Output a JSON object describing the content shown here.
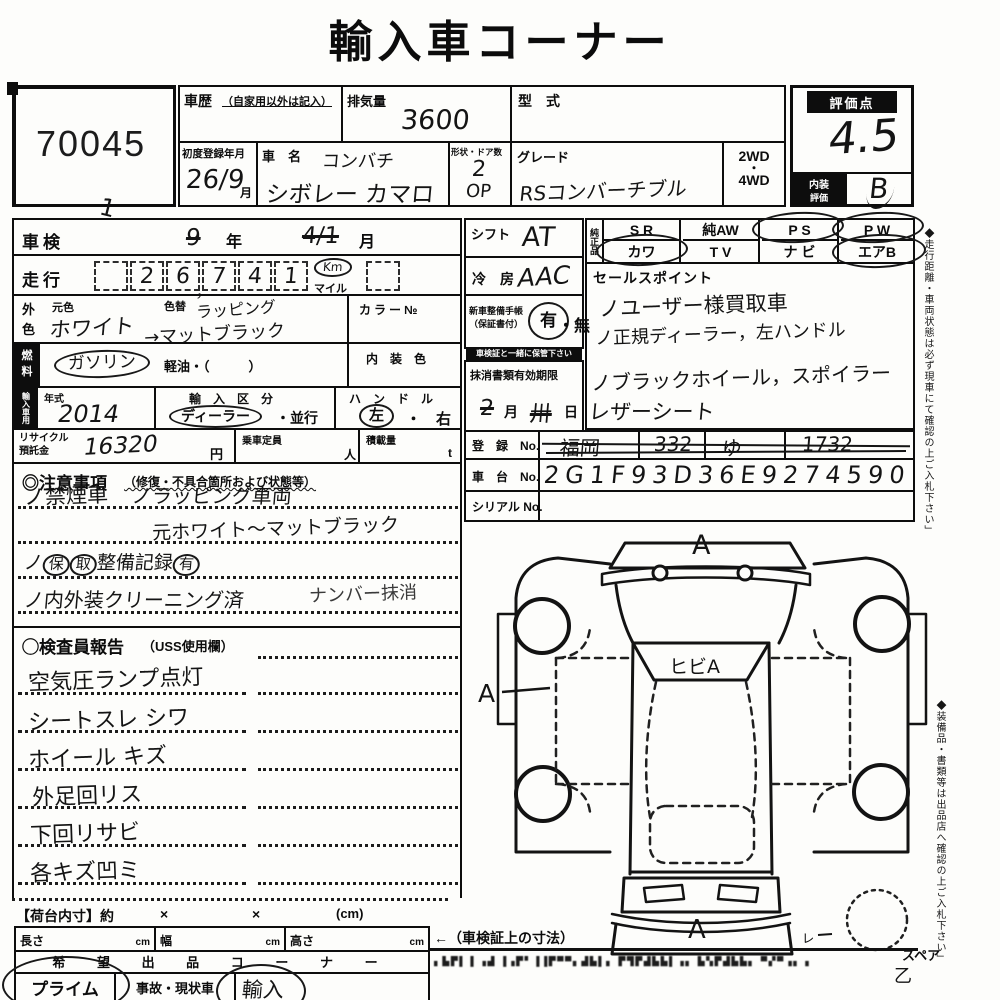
{
  "title": "輸入車コーナー",
  "lot_no": "70045",
  "header": {
    "history_label": "車歴",
    "history_note": "（自家用以外は記入）",
    "displacement_label": "排気量",
    "displacement_value": "3600",
    "model_code_label": "型　式",
    "first_reg_label": "初度登録年月",
    "first_reg_value": "26/9",
    "first_reg_unit": "月",
    "car_name_label": "車　名",
    "car_name_line1": "コンバチ",
    "car_name_line2": "シボレー カマロ",
    "shape_label": "形状・ドア数",
    "shape_value": "2",
    "shape_value2": "OP",
    "grade_label": "グレード",
    "grade_value": "RSコンバーチブル",
    "drive_2wd": "2WD",
    "drive_sep": "・",
    "drive_4wd": "4WD",
    "score_label": "評価点",
    "score_value": "4.5",
    "interior_label1": "内装",
    "interior_label2": "評価",
    "interior_value": "B"
  },
  "left": {
    "shaken_label": "車検",
    "shaken_year": "9",
    "year_unit": "年",
    "shaken_month": "4/1",
    "month_unit": "月",
    "stray_mark": "1",
    "mileage_label": "走行",
    "digits": [
      "",
      "2",
      "6",
      "7",
      "4",
      "1"
    ],
    "comma": "，",
    "unit_km": "Km",
    "unit_mile": "マイル",
    "color_label1": "外",
    "color_label2": "色",
    "orig_color_label": "元色",
    "orig_color_value": "ホワイト",
    "repaint_label": "色替",
    "repaint_value": "ラッピング",
    "repaint_value2": "→マットブラック",
    "color_no_label": "カラー№",
    "fuel_label1": "燃",
    "fuel_label2": "料",
    "fuel_gasoline": "ガソリン",
    "fuel_diesel": "軽油・（　　　）",
    "interior_color_label": "内　装　色",
    "import_label": "輸入車用",
    "year_label": "年式",
    "year_value": "2014",
    "import_class_label": "輸　入　区　分",
    "import_dealer": "ディーラー",
    "import_parallel": "・並行",
    "handle_label": "ハ　ン　ド　ル",
    "handle_left": "左",
    "handle_right": "・　右",
    "recycle_label1": "リサイクル",
    "recycle_label2": "預託金",
    "recycle_value": "16320",
    "recycle_unit": "円",
    "capacity_label": "乗車定員",
    "capacity_unit": "人",
    "load_label": "積載量",
    "load_unit": "t"
  },
  "middle": {
    "shift_label": "シフト",
    "shift_value": "AT",
    "ac_label": "冷　房",
    "ac_value": "AAC",
    "warranty_label": "新車整備手帳",
    "warranty_sub": "（保証書付）",
    "warranty_yes": "有",
    "warranty_no": "・無",
    "warranty_note": "車検証と一緒に保管下さい",
    "docs_label": "抹消書類有効期限",
    "docs_month": "2",
    "docs_month_unit": "月",
    "docs_day": "卅",
    "docs_day_unit": "日"
  },
  "equipment": {
    "label": "純正品",
    "cells": [
      "S R",
      "純AW",
      "P S",
      "P W",
      "カワ",
      "T V",
      "ナ ビ",
      "エアB"
    ]
  },
  "sales": {
    "label": "セールスポイント",
    "lines": [
      "ノユーザー様買取車",
      "ノ正規ディーラー，左ハンドル",
      "ノブラックホイール，スポイラー",
      "レザーシート"
    ]
  },
  "registration": {
    "reg_label": "登　録　No.",
    "reg_values": [
      "福岡",
      "332",
      "ゆ",
      "1732"
    ],
    "chassis_label": "車　台　No.",
    "chassis_value": "2G1F93D36E9274590",
    "serial_label": "シリアル No."
  },
  "cautions": {
    "label": "◎注意事項",
    "label_sub": "（修復・不具合箇所および状態等）",
    "line1a": "ノ禁煙車",
    "line1b": "ノラッピング車両",
    "line2": "元ホワイト〜マットブラック",
    "line3_check": "ノ",
    "line3_c1": "保",
    "line3_c2": "取",
    "line3_text": "整備記録",
    "line3_c3": "有",
    "line4": "ノ内外装クリーニング済",
    "line4b": "ナンバー抹消"
  },
  "inspector": {
    "label": "◯検査員報告",
    "label_sub": "（USS使用欄）",
    "lines": [
      "空気圧ランプ点灯",
      "シートスレ シワ",
      "ホイール キズ",
      "外足回リス",
      "下回リサビ",
      "各キズ凹ミ"
    ]
  },
  "cargo": {
    "label": "【荷台内寸】約",
    "times1": "×",
    "times2": "×",
    "unit": "(cm)",
    "length_label": "長さ",
    "width_label": "幅",
    "height_label": "高さ",
    "cm": "cm",
    "note": "←（車検証上の寸法）"
  },
  "corner": {
    "header": "希 望 出 品 コ ー ナ ー",
    "cell1": "プライム",
    "cell2": "事故・現状車",
    "circled": "輸入"
  },
  "diagram": {
    "mark_top": "A",
    "mark_crack": "ヒビA",
    "mark_left": "A",
    "mark_bottom": "A",
    "mark_small": "ㇾ",
    "spare_label": "スペア",
    "mark_corner": "乙"
  },
  "side_notes": {
    "note1": "◆走行距離・車両状態は必ず現車にて確認の上ご入札下さい」",
    "note2": "◆装備品・書類等は出品店へ確認の上ご入札下さい」"
  },
  "footer": {
    "illegible": "▖▙▛▌▐ ▗▟ ▐▗▛▘▐▐▛▀▀▖▟▙▌▖ ▛▜▛▟▙▙▌▗▖ ▙▚▛▟▙▙▖ ▀▞▀▗▖▗"
  }
}
